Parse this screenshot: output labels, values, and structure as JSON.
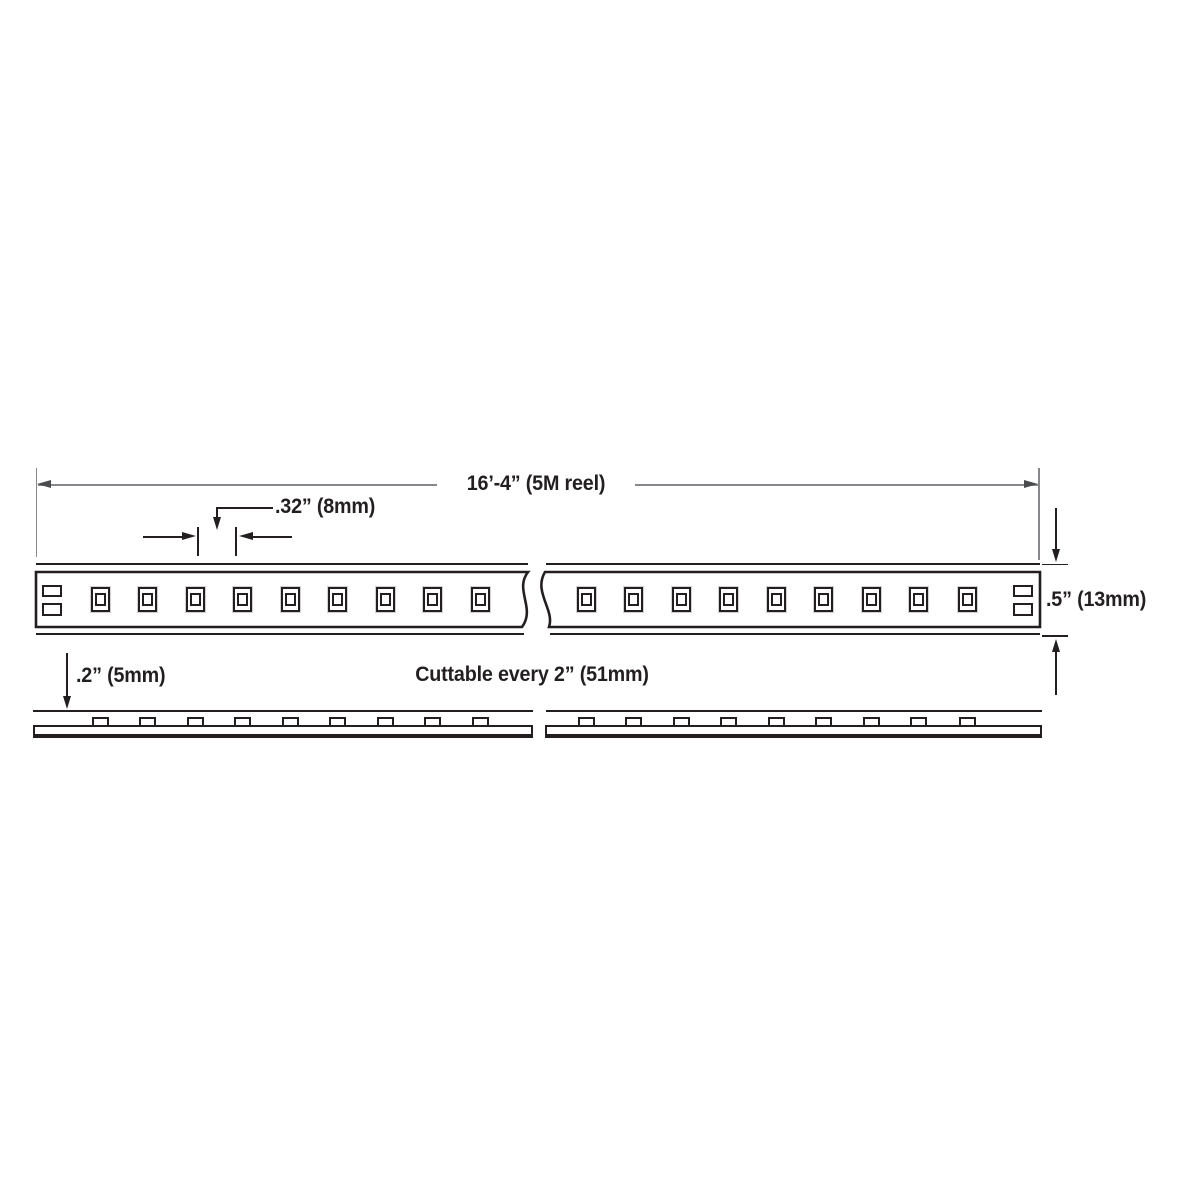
{
  "diagram_type": "led-strip-dimension-drawing",
  "labels": {
    "reel_length": "16’-4” (5M reel)",
    "led_pitch": ".32” (8mm)",
    "strip_width": ".5” (13mm)",
    "strip_profile_height": ".2” (5mm)",
    "cut_note": "Cuttable every 2” (51mm)"
  },
  "colors": {
    "ink": "#231f20",
    "dim": "#87888b",
    "dim_arrow": "#4a4b4d",
    "bg": "#ffffff"
  },
  "top_view": {
    "segments": [
      {
        "name": "left",
        "led_centers_x": [
          100,
          147.5,
          195,
          242.5,
          290,
          337.5,
          385,
          432.5,
          480
        ]
      },
      {
        "name": "right",
        "led_centers_x": [
          586,
          633.5,
          681,
          728.5,
          776,
          823.5,
          871,
          918.5,
          967
        ]
      }
    ],
    "leds_visible_per_segment": 9,
    "solder_pads_per_end": 2
  }
}
